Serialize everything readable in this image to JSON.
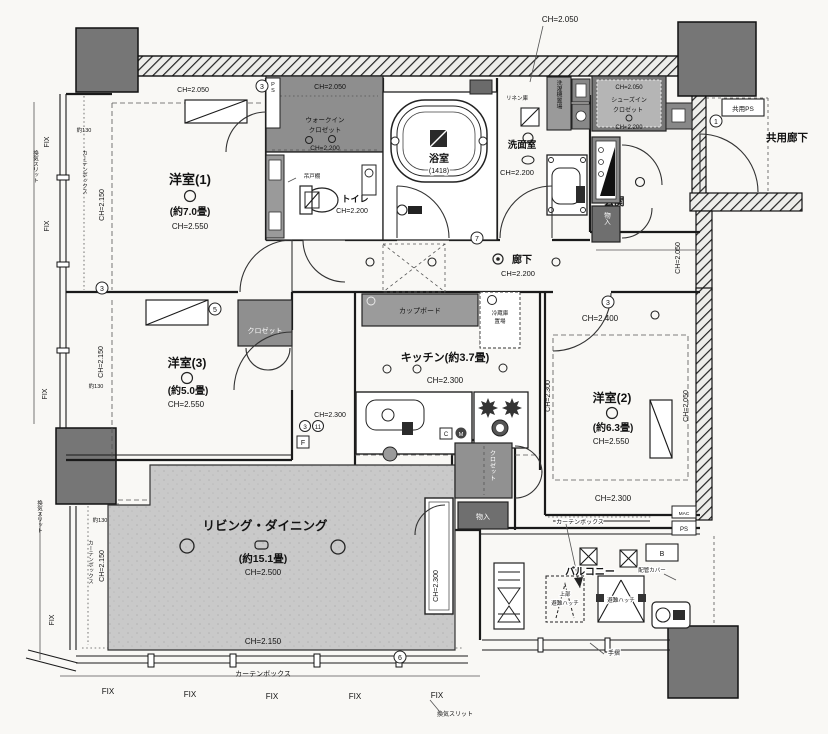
{
  "plan": {
    "rooms": {
      "y1": {
        "name": "洋室(1)",
        "size": "(約7.0畳)"
      },
      "y2": {
        "name": "洋室(2)",
        "size": "(約6.3畳)"
      },
      "y3": {
        "name": "洋室(3)",
        "size": "(約5.0畳)"
      },
      "living": {
        "name": "リビング・ダイニング",
        "size": "(約15.1畳)"
      },
      "kitchen": {
        "name": "キッチン(約3.7畳)"
      },
      "bath": {
        "name": "浴室",
        "size": "(1418)"
      },
      "wash": {
        "name": "洗面室"
      },
      "toilet": {
        "name": "トイレ"
      },
      "hall": {
        "name": "廊下"
      },
      "entrance": {
        "name": "玄関"
      },
      "balcony": {
        "name": "バルコニー"
      },
      "corridor": {
        "name": "共用廊下"
      },
      "wic_line1": "ウォークイン",
      "wic_line2": "クロゼット",
      "sic_line1": "シューズイン",
      "sic_line2": "クロゼット"
    },
    "ch": {
      "v2050": "CH=2.050",
      "v2150": "CH=2.150",
      "v2200": "CH=2.200",
      "v2300": "CH=2.300",
      "v2400": "CH=2.400",
      "v2500": "CH=2.500",
      "v2550": "CH=2.550"
    },
    "misc": {
      "fix": "FIX",
      "vent_slit": "換気スリット",
      "curtain_box": "カーテンボックス",
      "about130": "約130",
      "kyoyo_ps": "共用PS",
      "ps": "PS",
      "mac": "MAC",
      "b": "B",
      "f": "F",
      "c": "C",
      "m": "M",
      "tesuri": "手摺",
      "pipe_cover": "配管カバー",
      "jobu": "上部",
      "hinan_hatch": "避難ハッチ",
      "cupboard": "カップボード",
      "fridge1": "冷蔵庫",
      "fridge2": "置場",
      "laundry": "洗濯機置場",
      "linen": "リネン庫",
      "tsuridana": "吊戸棚",
      "closet": "クロゼット",
      "monoire": "物入",
      "size_1418": "(1418)"
    },
    "markers": {
      "n1": "1",
      "n3": "3",
      "n5": "5",
      "n6": "6",
      "n7": "7",
      "n11": "11"
    }
  }
}
